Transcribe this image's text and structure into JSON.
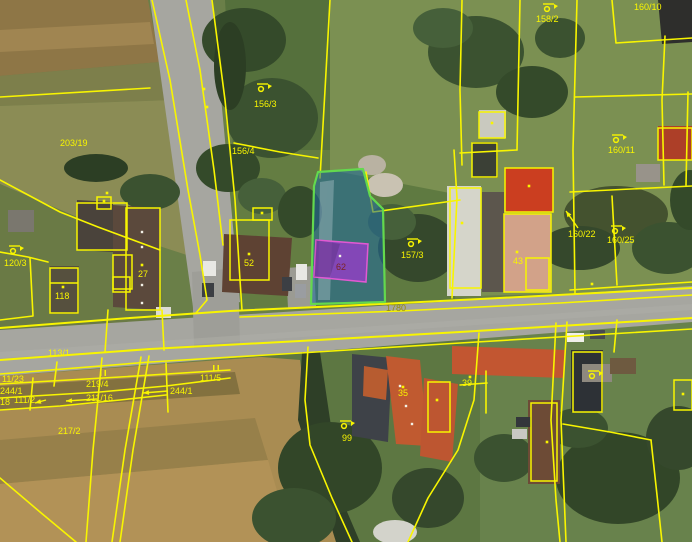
{
  "meta": {
    "width": 692,
    "height": 542
  },
  "palette": {
    "boundary_yellow": "#f8f500",
    "highlight_parcel_fill": "rgba(30,105,160,0.55)",
    "highlight_parcel_stroke": "#63d94e",
    "highlight_building_fill": "rgba(148,62,198,0.82)",
    "highlight_building_stroke": "#e259d2",
    "label_yellow": "#f8f500",
    "road_label_olive": "#968c0a",
    "building_label_maroon": "#7c2424"
  },
  "terrain": [
    {
      "t": "r",
      "x": 0,
      "y": 0,
      "w": 692,
      "h": 542,
      "f": "#6a7f48"
    },
    {
      "t": "p",
      "pts": "0,0 148,0 160,62 0,76",
      "f": "#8e7646"
    },
    {
      "t": "p",
      "pts": "0,30 150,22 154,44 0,52",
      "f": "#a08551"
    },
    {
      "t": "p",
      "pts": "0,76 160,62 172,100 0,106",
      "f": "#7d7f4b"
    },
    {
      "t": "p",
      "pts": "0,106 172,100 196,258 98,226 0,184",
      "f": "#8b8c55"
    },
    {
      "t": "p",
      "pts": "0,184 98,226 160,252 166,360 0,362",
      "f": "#6a7a45"
    },
    {
      "t": "p",
      "pts": "330,0 692,0 692,290 330,300",
      "f": "#7b9052"
    },
    {
      "t": "p",
      "pts": "225,0 330,0 330,180 235,185",
      "f": "#55703c"
    },
    {
      "t": "p",
      "pts": "196,150 330,150 330,305 200,310",
      "f": "#647d42"
    },
    {
      "t": "p",
      "pts": "330,170 460,195 455,300 315,305",
      "f": "#5f7a41"
    },
    {
      "t": "p",
      "pts": "0,376 330,352 362,542 0,542",
      "f": "#a98c52"
    },
    {
      "t": "p",
      "pts": "0,386 235,372 240,394 0,410",
      "f": "#83713f"
    },
    {
      "t": "p",
      "pts": "0,440 255,418 268,460 0,484",
      "f": "#97804a"
    },
    {
      "t": "p",
      "pts": "0,484 268,460 292,542 0,542",
      "f": "#b29257"
    },
    {
      "t": "p",
      "pts": "250,356 480,338 480,542 352,542 330,470 305,400 300,360",
      "f": "#5d7742"
    },
    {
      "t": "p",
      "pts": "480,320 692,305 692,542 480,542",
      "f": "#68824c"
    }
  ],
  "roads": [
    {
      "t": "p",
      "pts": "150,0 212,0 240,302 194,314",
      "f": "#a6a6a0"
    },
    {
      "t": "p",
      "pts": "0,330 692,286 692,322 0,376",
      "f": "#a6a6a0"
    },
    {
      "t": "p",
      "pts": "192,272 238,268 240,345 194,348",
      "f": "#9e9e98"
    },
    {
      "t": "p",
      "pts": "286,268 314,266 316,306 288,308",
      "f": "#9b9b93"
    },
    {
      "t": "p",
      "pts": "0,352 692,304 692,310 0,358",
      "f": "#b0b0a9",
      "o": 0.45
    },
    {
      "t": "p",
      "pts": "302,352 320,352 342,500 360,542 336,542 298,420",
      "f": "#2e3f27"
    }
  ],
  "trees": [
    {
      "t": "e",
      "cx": 244,
      "cy": 40,
      "rx": 42,
      "ry": 32,
      "f": "#344a2a"
    },
    {
      "t": "e",
      "cx": 272,
      "cy": 118,
      "rx": 46,
      "ry": 40,
      "f": "#3b5230"
    },
    {
      "t": "e",
      "cx": 228,
      "cy": 168,
      "rx": 32,
      "ry": 24,
      "f": "#344a2a"
    },
    {
      "t": "e",
      "cx": 150,
      "cy": 192,
      "rx": 30,
      "ry": 18,
      "f": "#3b5230"
    },
    {
      "t": "e",
      "cx": 96,
      "cy": 168,
      "rx": 32,
      "ry": 14,
      "f": "#2c3e24"
    },
    {
      "t": "e",
      "cx": 262,
      "cy": 196,
      "rx": 24,
      "ry": 18,
      "f": "#46603a"
    },
    {
      "t": "e",
      "cx": 300,
      "cy": 212,
      "rx": 22,
      "ry": 26,
      "f": "#344a2a"
    },
    {
      "t": "e",
      "cx": 230,
      "cy": 66,
      "rx": 16,
      "ry": 44,
      "f": "#2c3e24"
    },
    {
      "t": "e",
      "cx": 476,
      "cy": 52,
      "rx": 48,
      "ry": 36,
      "f": "#3b5230"
    },
    {
      "t": "e",
      "cx": 532,
      "cy": 92,
      "rx": 36,
      "ry": 26,
      "f": "#344a2a"
    },
    {
      "t": "e",
      "cx": 443,
      "cy": 28,
      "rx": 30,
      "ry": 20,
      "f": "#46603a"
    },
    {
      "t": "e",
      "cx": 560,
      "cy": 38,
      "rx": 25,
      "ry": 20,
      "f": "#3b5230"
    },
    {
      "t": "e",
      "cx": 418,
      "cy": 248,
      "rx": 40,
      "ry": 34,
      "f": "#35482c"
    },
    {
      "t": "e",
      "cx": 392,
      "cy": 222,
      "rx": 24,
      "ry": 18,
      "f": "#46603a"
    },
    {
      "t": "e",
      "cx": 616,
      "cy": 214,
      "rx": 52,
      "ry": 28,
      "f": "#44522f"
    },
    {
      "t": "e",
      "cx": 580,
      "cy": 248,
      "rx": 40,
      "ry": 22,
      "f": "#35482c"
    },
    {
      "t": "e",
      "cx": 668,
      "cy": 248,
      "rx": 36,
      "ry": 26,
      "f": "#3b5230"
    },
    {
      "t": "e",
      "cx": 690,
      "cy": 200,
      "rx": 20,
      "ry": 30,
      "f": "#344a2a"
    },
    {
      "t": "e",
      "cx": 385,
      "cy": 185,
      "rx": 18,
      "ry": 12,
      "f": "#c9c2b2"
    },
    {
      "t": "e",
      "cx": 372,
      "cy": 165,
      "rx": 14,
      "ry": 10,
      "f": "#b9b2a2"
    },
    {
      "t": "e",
      "cx": 330,
      "cy": 468,
      "rx": 52,
      "ry": 46,
      "f": "#324628"
    },
    {
      "t": "e",
      "cx": 294,
      "cy": 518,
      "rx": 42,
      "ry": 30,
      "f": "#3b5230"
    },
    {
      "t": "e",
      "cx": 428,
      "cy": 498,
      "rx": 36,
      "ry": 30,
      "f": "#35482c"
    },
    {
      "t": "e",
      "cx": 504,
      "cy": 458,
      "rx": 30,
      "ry": 24,
      "f": "#3b5230"
    },
    {
      "t": "e",
      "cx": 618,
      "cy": 478,
      "rx": 62,
      "ry": 46,
      "f": "#324628"
    },
    {
      "t": "e",
      "cx": 578,
      "cy": 428,
      "rx": 30,
      "ry": 20,
      "f": "#3b5230"
    },
    {
      "t": "e",
      "cx": 678,
      "cy": 438,
      "rx": 32,
      "ry": 32,
      "f": "#35482c"
    }
  ],
  "roofs": [
    {
      "t": "p",
      "pts": "77,200 113,202 113,252 77,250",
      "f": "#4a433b"
    },
    {
      "t": "p",
      "pts": "113,205 160,208 160,310 113,307",
      "f": "#5b493c"
    },
    {
      "t": "r",
      "x": 50,
      "y": 266,
      "w": 29,
      "h": 48,
      "f": "#56503e"
    },
    {
      "t": "r",
      "x": 8,
      "y": 210,
      "w": 26,
      "h": 22,
      "f": "#7a776e"
    },
    {
      "t": "p",
      "pts": "224,234 292,238 288,296 222,292",
      "f": "#5e4233"
    },
    {
      "t": "r",
      "x": 447,
      "y": 186,
      "w": 34,
      "h": 110,
      "f": "#d5d5ca"
    },
    {
      "t": "r",
      "x": 482,
      "y": 192,
      "w": 22,
      "h": 100,
      "f": "#5c564d"
    },
    {
      "t": "r",
      "x": 505,
      "y": 168,
      "w": 48,
      "h": 44,
      "f": "#cb3e20"
    },
    {
      "t": "p",
      "pts": "504,214 551,214 551,292 504,292",
      "f": "#d2a289"
    },
    {
      "t": "r",
      "x": 479,
      "y": 110,
      "w": 27,
      "h": 28,
      "f": "#c9c9bf"
    },
    {
      "t": "r",
      "x": 472,
      "y": 142,
      "w": 26,
      "h": 36,
      "f": "#3b4036"
    },
    {
      "t": "p",
      "pts": "658,0 692,0 692,42 662,44",
      "f": "#2e2e2c"
    },
    {
      "t": "r",
      "x": 658,
      "y": 126,
      "w": 34,
      "h": 34,
      "f": "#ad3f28"
    },
    {
      "t": "r",
      "x": 636,
      "y": 164,
      "w": 24,
      "h": 18,
      "f": "#98938a"
    },
    {
      "t": "p",
      "pts": "352,354 392,358 388,442 352,436",
      "f": "#3e4248"
    },
    {
      "t": "p",
      "pts": "364,366 388,370 386,400 363,396",
      "f": "#b75c30"
    },
    {
      "t": "p",
      "pts": "386,356 420,360 428,446 396,444",
      "f": "#c05a30"
    },
    {
      "t": "p",
      "pts": "424,378 458,384 452,462 420,456",
      "f": "#bd5631"
    },
    {
      "t": "p",
      "pts": "452,346 566,350 564,378 452,374",
      "f": "#c25631"
    },
    {
      "t": "r",
      "x": 528,
      "y": 400,
      "w": 32,
      "h": 84,
      "f": "#6d4b36"
    },
    {
      "t": "r",
      "x": 571,
      "y": 350,
      "w": 32,
      "h": 62,
      "f": "#2d3136"
    },
    {
      "t": "r",
      "x": 582,
      "y": 364,
      "w": 30,
      "h": 18,
      "f": "#8e897f"
    },
    {
      "t": "r",
      "x": 610,
      "y": 358,
      "w": 26,
      "h": 16,
      "f": "#6e5a40"
    },
    {
      "t": "e",
      "cx": 395,
      "cy": 532,
      "rx": 22,
      "ry": 12,
      "f": "#d3d3cb"
    }
  ],
  "cars": [
    {
      "t": "r",
      "x": 203,
      "y": 261,
      "w": 13,
      "h": 15,
      "f": "#e8e8e4"
    },
    {
      "t": "r",
      "x": 202,
      "y": 283,
      "w": 12,
      "h": 14,
      "f": "#3c3f44"
    },
    {
      "t": "r",
      "x": 156,
      "y": 307,
      "w": 15,
      "h": 11,
      "f": "#dcdcd6"
    },
    {
      "t": "r",
      "x": 296,
      "y": 264,
      "w": 11,
      "h": 16,
      "f": "#e8e8e4"
    },
    {
      "t": "r",
      "x": 282,
      "y": 277,
      "w": 10,
      "h": 14,
      "f": "#3c3f44"
    },
    {
      "t": "r",
      "x": 295,
      "y": 284,
      "w": 11,
      "h": 14,
      "f": "#9a9da1"
    },
    {
      "t": "r",
      "x": 567,
      "y": 333,
      "w": 17,
      "h": 9,
      "f": "#f0f0ea"
    },
    {
      "t": "r",
      "x": 590,
      "y": 330,
      "w": 15,
      "h": 9,
      "f": "#474a4f"
    },
    {
      "t": "r",
      "x": 516,
      "y": 417,
      "w": 15,
      "h": 10,
      "f": "#33363b"
    },
    {
      "t": "r",
      "x": 512,
      "y": 429,
      "w": 15,
      "h": 10,
      "f": "#c9c9c3"
    }
  ],
  "parcel_lines": [
    {
      "pts": "152,0 170,80 188,190 200,255 207,300 196,313"
    },
    {
      "pts": "212,0 225,100 235,200 240,280 242,310"
    },
    {
      "pts": "186,0 200,70 214,170 223,245"
    },
    {
      "pts": "0,97 150,88"
    },
    {
      "pts": "0,180 60,212 98,227 160,250"
    },
    {
      "pts": "330,0 325,90 320,178"
    },
    {
      "pts": "366,172 373,212 460,200"
    },
    {
      "pts": "454,150 457,198 452,298"
    },
    {
      "pts": "462,0 460,90 462,165"
    },
    {
      "pts": "520,0 517,150"
    },
    {
      "pts": "460,153 517,150"
    },
    {
      "pts": "577,0 573,150 575,293"
    },
    {
      "pts": "575,97 692,94"
    },
    {
      "pts": "570,192 692,186"
    },
    {
      "pts": "570,290 692,282"
    },
    {
      "pts": "612,0 616,43 692,38"
    },
    {
      "pts": "665,36 662,100 664,185"
    },
    {
      "pts": "688,92 686,185"
    },
    {
      "pts": "612,196 617,285"
    },
    {
      "pts": "0,328 130,318 230,311 340,306 500,298 692,288",
      "w": 2
    },
    {
      "pts": "240,317 400,311 560,303 692,295"
    },
    {
      "pts": "0,360 150,349 300,341 460,332 692,318",
      "w": 2
    },
    {
      "pts": "0,374 150,362 300,353 460,343 692,329"
    },
    {
      "pts": "0,384 120,377 230,370"
    },
    {
      "pts": "0,398 100,392 166,386 230,378"
    },
    {
      "pts": "0,410 60,406 120,400 166,395"
    },
    {
      "pts": "166,363 168,412"
    },
    {
      "pts": "33,378 30,410"
    },
    {
      "pts": "57,362 54,386"
    },
    {
      "pts": "102,358 93,450 86,542"
    },
    {
      "pts": "141,357 125,450 112,542"
    },
    {
      "pts": "149,356 133,450 120,542"
    },
    {
      "pts": "0,478 40,512 76,542"
    },
    {
      "pts": "308,347 305,400 310,445 332,498 352,542"
    },
    {
      "pts": "479,333 474,400 458,450 428,498 408,542"
    },
    {
      "pts": "460,385 487,383"
    },
    {
      "pts": "486,371 486,413"
    },
    {
      "pts": "556,323 551,420 556,500 560,542"
    },
    {
      "pts": "567,322 561,420 566,542"
    },
    {
      "pts": "563,424 610,432 651,440"
    },
    {
      "pts": "651,440 657,495 662,542"
    },
    {
      "pts": "617,320 614,352"
    },
    {
      "pts": "234,143 280,152 318,158"
    },
    {
      "pts": "162,310 164,350"
    },
    {
      "pts": "108,310 105,352"
    },
    {
      "pts": "0,252 28,257 48,262"
    },
    {
      "pts": "30,258 33,316 0,320"
    }
  ],
  "building_outlines": [
    {
      "t": "r",
      "x": 50,
      "y": 268,
      "w": 28,
      "h": 45
    },
    {
      "t": "l",
      "pts": "50,283 78,283"
    },
    {
      "t": "r",
      "x": 97,
      "y": 197,
      "w": 14,
      "h": 12
    },
    {
      "t": "r",
      "x": 126,
      "y": 208,
      "w": 34,
      "h": 102
    },
    {
      "t": "r",
      "x": 113,
      "y": 255,
      "w": 19,
      "h": 34
    },
    {
      "t": "r",
      "x": 113,
      "y": 277,
      "w": 17,
      "h": 15
    },
    {
      "t": "r",
      "x": 77,
      "y": 203,
      "w": 50,
      "h": 47
    },
    {
      "t": "r",
      "x": 230,
      "y": 220,
      "w": 39,
      "h": 60
    },
    {
      "t": "r",
      "x": 253,
      "y": 208,
      "w": 19,
      "h": 12
    },
    {
      "t": "r",
      "x": 450,
      "y": 188,
      "w": 31,
      "h": 100
    },
    {
      "t": "r",
      "x": 504,
      "y": 214,
      "w": 47,
      "h": 78
    },
    {
      "t": "r",
      "x": 526,
      "y": 258,
      "w": 23,
      "h": 32
    },
    {
      "t": "r",
      "x": 505,
      "y": 168,
      "w": 48,
      "h": 44
    },
    {
      "t": "r",
      "x": 479,
      "y": 112,
      "w": 26,
      "h": 26
    },
    {
      "t": "r",
      "x": 472,
      "y": 143,
      "w": 25,
      "h": 34
    },
    {
      "t": "r",
      "x": 428,
      "y": 382,
      "w": 22,
      "h": 50
    },
    {
      "t": "r",
      "x": 531,
      "y": 403,
      "w": 26,
      "h": 78
    },
    {
      "t": "r",
      "x": 573,
      "y": 352,
      "w": 29,
      "h": 60
    },
    {
      "t": "r",
      "x": 674,
      "y": 380,
      "w": 18,
      "h": 30
    },
    {
      "t": "r",
      "x": 658,
      "y": 128,
      "w": 34,
      "h": 32
    }
  ],
  "highlights": {
    "parcel": {
      "pts": "318,172 363,169 370,196 383,209 385,302 311,304 314,186"
    },
    "inner_path": {
      "pts": "320,182 334,180 330,300 318,300",
      "fill": "rgba(215,225,235,0.30)"
    },
    "building": {
      "pts": "316,240 368,244 366,282 314,277"
    },
    "building_facet": {
      "pts": "316,240 340,244 330,277 314,277",
      "fill": "rgba(0,0,0,0.14)"
    }
  },
  "symbols": {
    "flags": [
      [
        262,
        87
      ],
      [
        548,
        7
      ],
      [
        617,
        138
      ],
      [
        616,
        229
      ],
      [
        412,
        242
      ],
      [
        14,
        249
      ],
      [
        345,
        424
      ],
      [
        593,
        374
      ]
    ],
    "parallels": [
      [
        100,
        370
      ],
      [
        213,
        365
      ]
    ],
    "dots": [
      [
        63,
        287
      ],
      [
        142,
        265
      ],
      [
        249,
        254
      ],
      [
        262,
        213
      ],
      [
        104,
        201
      ],
      [
        529,
        186
      ],
      [
        517,
        252
      ],
      [
        462,
        223
      ],
      [
        403,
        387
      ],
      [
        470,
        377
      ],
      [
        547,
        442
      ],
      [
        437,
        400
      ],
      [
        683,
        394
      ],
      [
        492,
        123
      ],
      [
        204,
        89
      ],
      [
        207,
        107
      ],
      [
        107,
        193
      ],
      [
        592,
        284
      ]
    ],
    "white_dots": [
      [
        340,
        256
      ],
      [
        142,
        232
      ],
      [
        142,
        247
      ],
      [
        142,
        285
      ],
      [
        142,
        303
      ],
      [
        400,
        386
      ],
      [
        406,
        406
      ],
      [
        412,
        424
      ]
    ]
  },
  "arrows": [
    {
      "tail": [
        97,
        399
      ],
      "head": [
        66,
        401
      ]
    },
    {
      "tail": [
        168,
        391
      ],
      "head": [
        143,
        393
      ]
    },
    {
      "tail": [
        46,
        400
      ],
      "head": [
        35,
        403
      ]
    },
    {
      "tail": [
        578,
        228
      ],
      "head": [
        566,
        211
      ]
    }
  ],
  "labels": [
    {
      "t": "203/19",
      "x": 60,
      "y": 146
    },
    {
      "t": "156/3",
      "x": 254,
      "y": 107
    },
    {
      "t": "156/4",
      "x": 232,
      "y": 154
    },
    {
      "t": "158/2",
      "x": 536,
      "y": 22
    },
    {
      "t": "160/10",
      "x": 634,
      "y": 10
    },
    {
      "t": "160/11",
      "x": 608,
      "y": 153
    },
    {
      "t": "160/22",
      "x": 568,
      "y": 237
    },
    {
      "t": "160/25",
      "x": 607,
      "y": 243
    },
    {
      "t": "157/3",
      "x": 401,
      "y": 258
    },
    {
      "t": "120/3",
      "x": 4,
      "y": 266
    },
    {
      "t": "118",
      "x": 55,
      "y": 299
    },
    {
      "t": "27",
      "x": 138,
      "y": 277
    },
    {
      "t": "52",
      "x": 244,
      "y": 266
    },
    {
      "t": "62",
      "x": 336,
      "y": 270,
      "c": "maroon"
    },
    {
      "t": "1780",
      "x": 386,
      "y": 311,
      "c": "olive"
    },
    {
      "t": "43",
      "x": 513,
      "y": 264
    },
    {
      "t": "113/1",
      "x": 48,
      "y": 356
    },
    {
      "t": "11/23",
      "x": 2,
      "y": 382
    },
    {
      "t": "219/4",
      "x": 86,
      "y": 387
    },
    {
      "t": "111/5",
      "x": 200,
      "y": 381
    },
    {
      "t": "244/1",
      "x": 0,
      "y": 394
    },
    {
      "t": "18",
      "x": 0,
      "y": 405
    },
    {
      "t": "111/2",
      "x": 14,
      "y": 403
    },
    {
      "t": "211/16",
      "x": 86,
      "y": 401
    },
    {
      "t": "244/1",
      "x": 170,
      "y": 394
    },
    {
      "t": "217/2",
      "x": 58,
      "y": 434
    },
    {
      "t": "99",
      "x": 342,
      "y": 441
    },
    {
      "t": "35",
      "x": 398,
      "y": 396
    },
    {
      "t": "39",
      "x": 462,
      "y": 386
    }
  ]
}
